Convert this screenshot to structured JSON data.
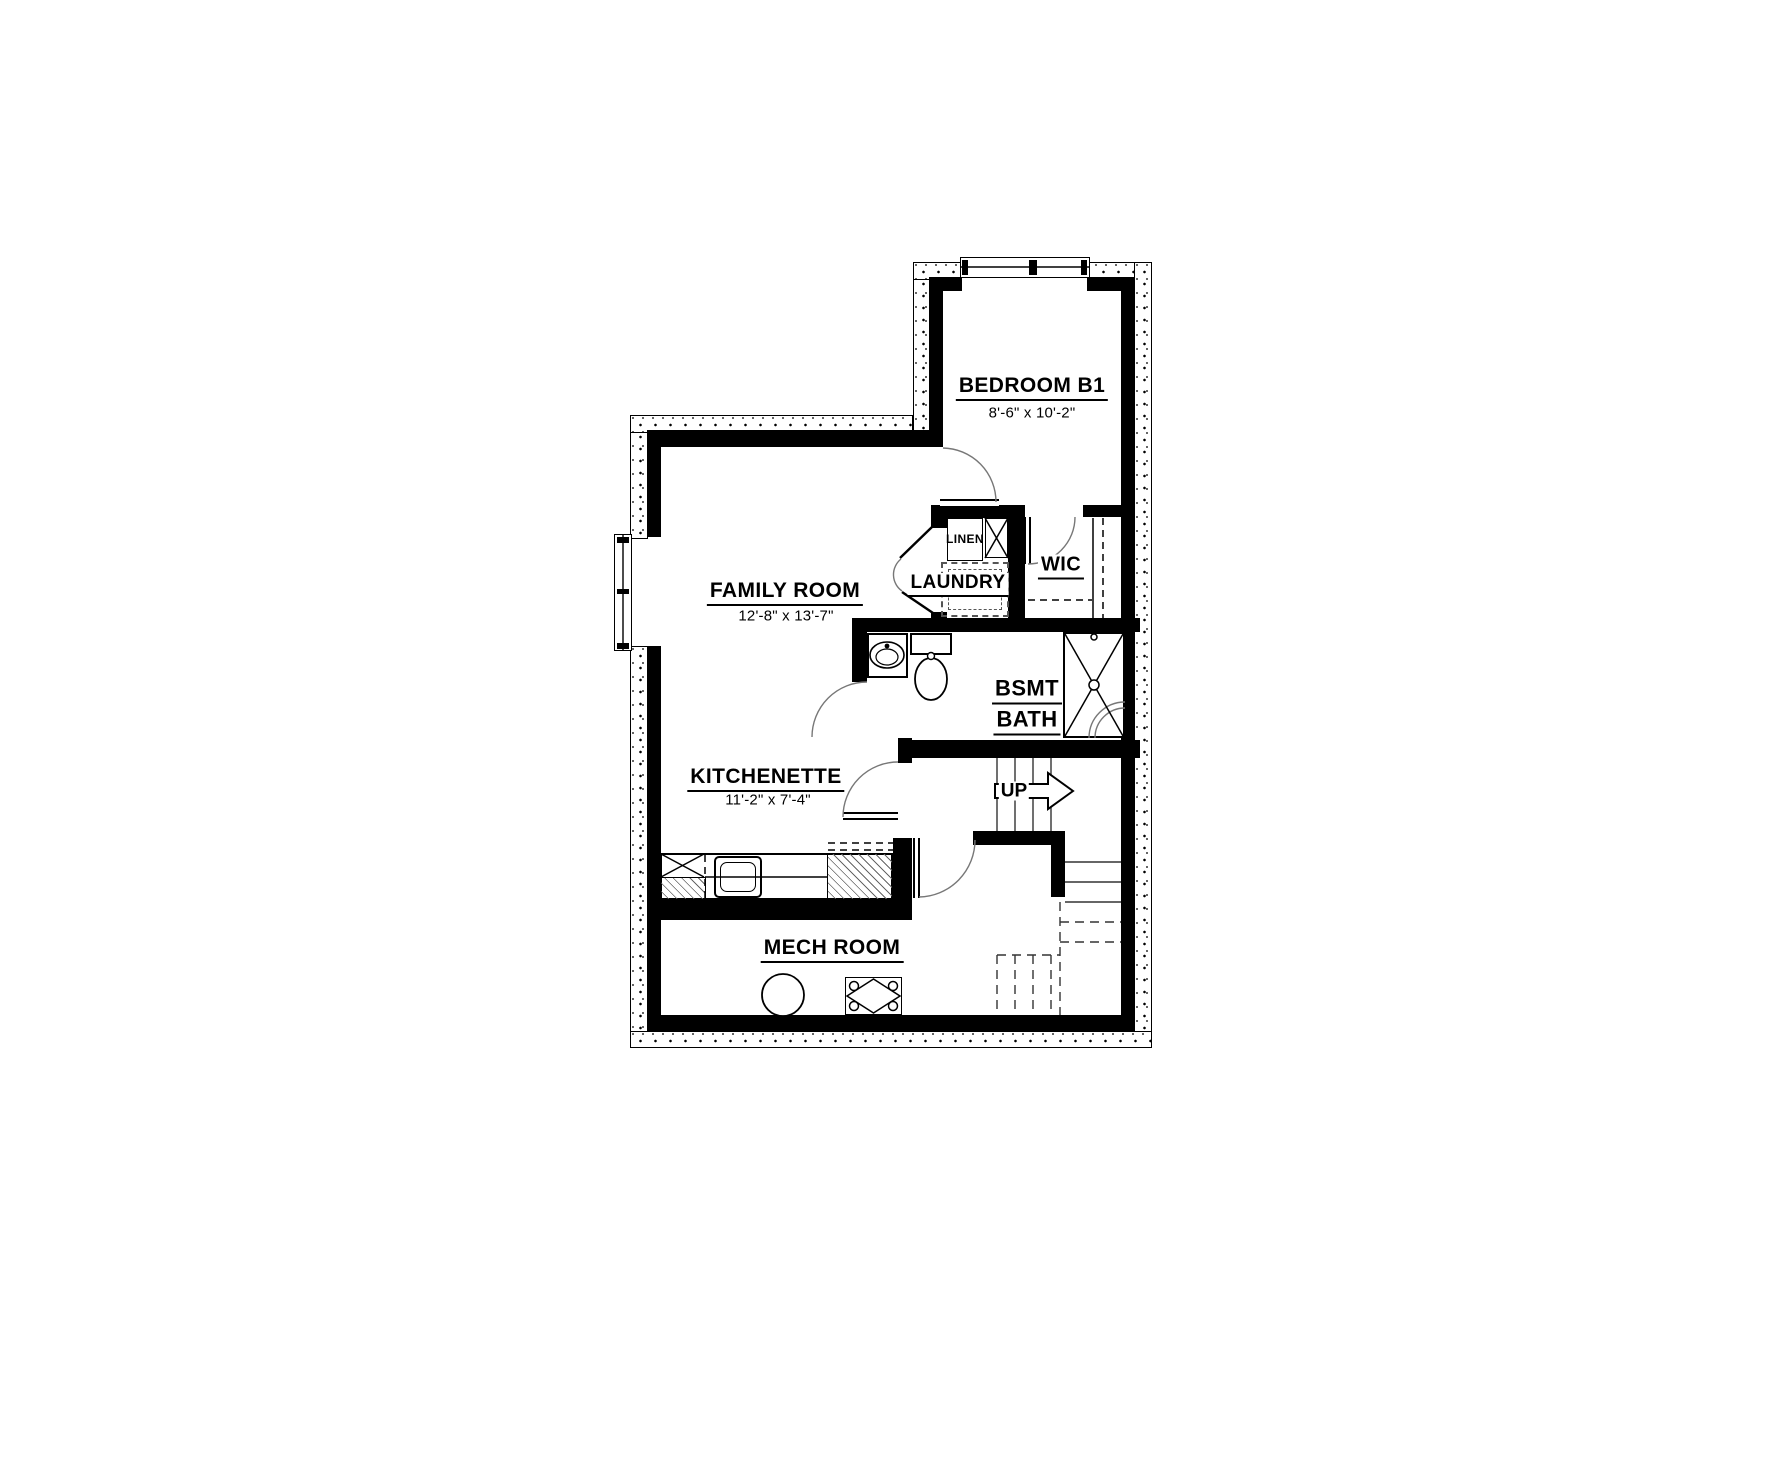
{
  "plan": {
    "title": "Basement Floor Plan",
    "rooms": {
      "bedroom": {
        "label": "BEDROOM B1",
        "dims": "8'-6\" x 10'-2\""
      },
      "family": {
        "label": "FAMILY ROOM",
        "dims": "12'-8\" x 13'-7\""
      },
      "kitchenette": {
        "label": "KITCHENETTE",
        "dims": "11'-2\" x 7'-4\""
      },
      "wic": {
        "label": "WIC"
      },
      "laundry": {
        "label": "LAUNDRY"
      },
      "linen": {
        "label": "LINEN"
      },
      "bath": {
        "label_line1": "BSMT",
        "label_line2": "BATH"
      },
      "mech": {
        "label": "MECH ROOM"
      },
      "stairs": {
        "label": "UP"
      }
    },
    "colors": {
      "line": "#000000",
      "background": "#ffffff",
      "hatch": "#666666",
      "arc": "#777777"
    }
  }
}
